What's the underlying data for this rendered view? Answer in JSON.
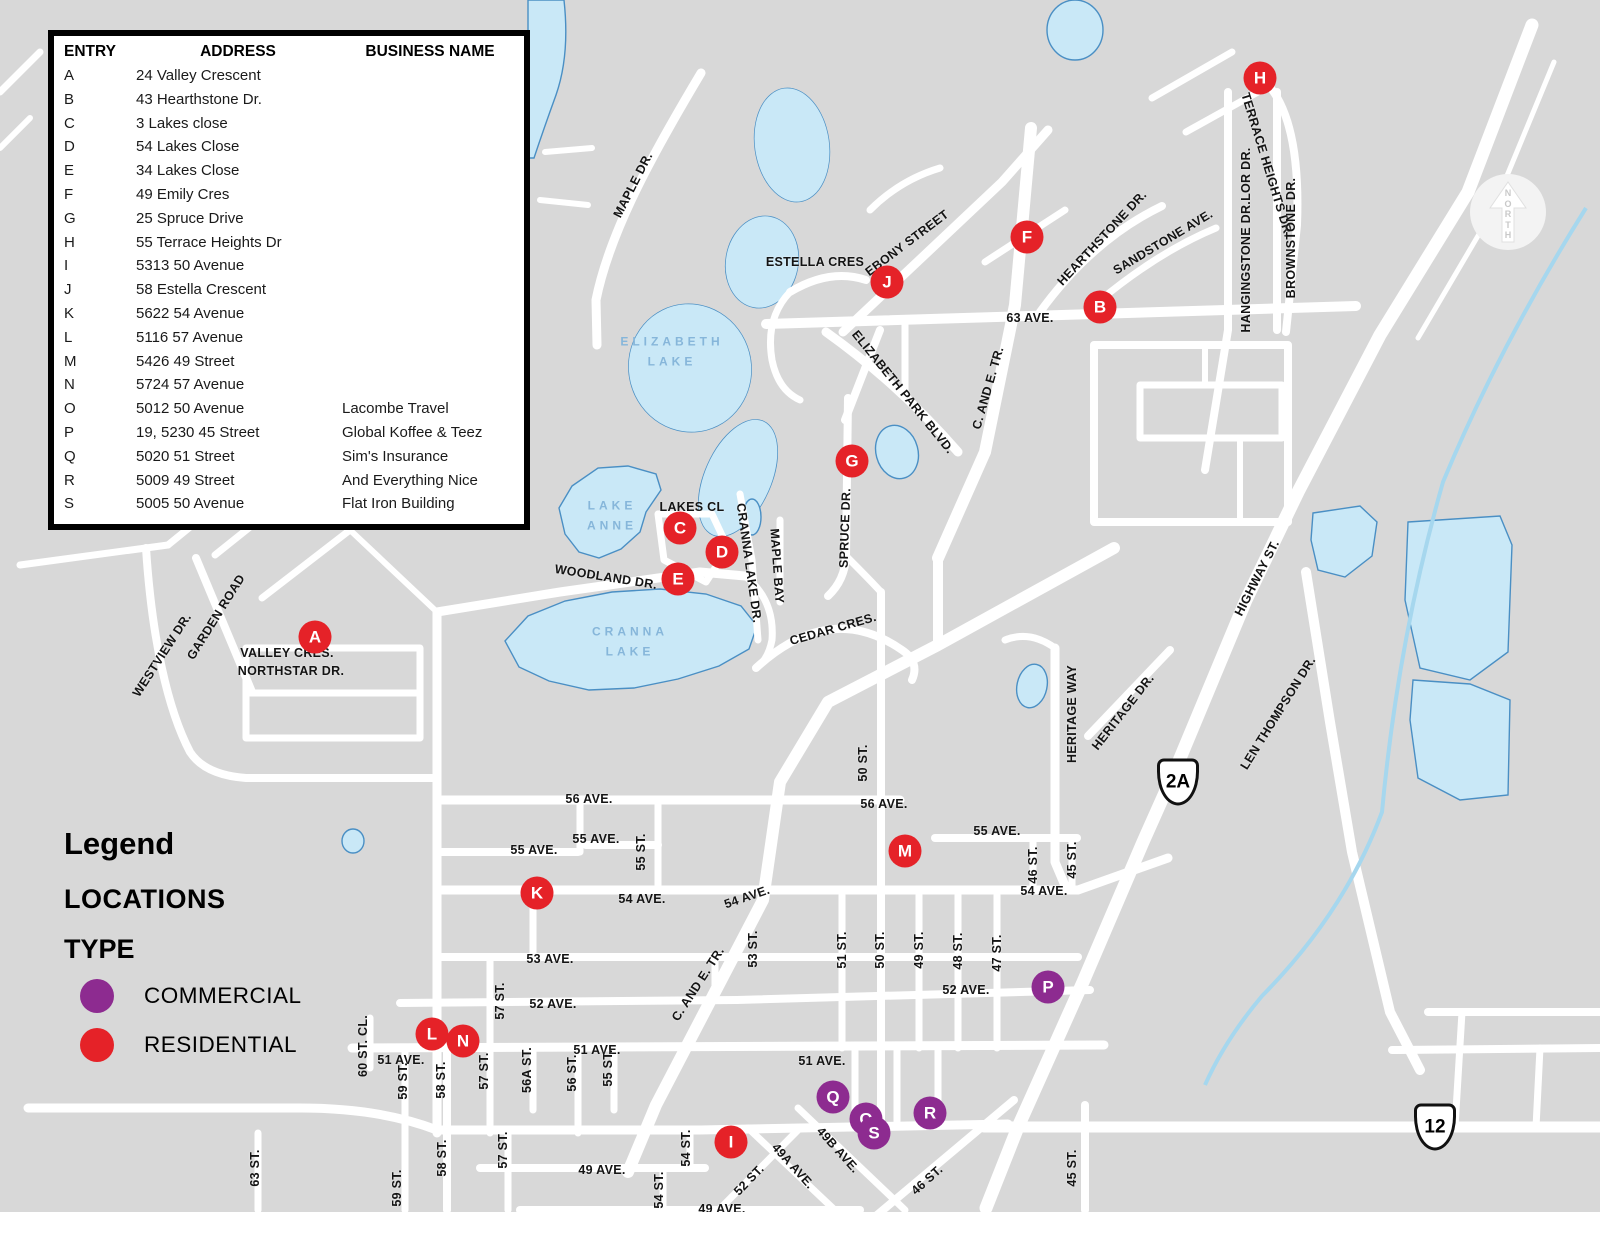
{
  "table": {
    "headers": [
      "ENTRY",
      "ADDRESS",
      "BUSINESS NAME"
    ],
    "rows": [
      {
        "entry": "A",
        "address": "24 Valley Crescent",
        "business": ""
      },
      {
        "entry": "B",
        "address": "43 Hearthstone Dr.",
        "business": ""
      },
      {
        "entry": "C",
        "address": "3 Lakes close",
        "business": ""
      },
      {
        "entry": "D",
        "address": "54 Lakes Close",
        "business": ""
      },
      {
        "entry": "E",
        "address": "34 Lakes Close",
        "business": ""
      },
      {
        "entry": "F",
        "address": "49 Emily Cres",
        "business": ""
      },
      {
        "entry": "G",
        "address": "25 Spruce Drive",
        "business": ""
      },
      {
        "entry": "H",
        "address": "55 Terrace Heights Dr",
        "business": ""
      },
      {
        "entry": "I",
        "address": "5313 50 Avenue",
        "business": ""
      },
      {
        "entry": "J",
        "address": "58 Estella Crescent",
        "business": ""
      },
      {
        "entry": "K",
        "address": "5622 54 Avenue",
        "business": ""
      },
      {
        "entry": "L",
        "address": "5116 57 Avenue",
        "business": ""
      },
      {
        "entry": "M",
        "address": "5426 49 Street",
        "business": ""
      },
      {
        "entry": "N",
        "address": "5724 57 Avenue",
        "business": ""
      },
      {
        "entry": "O",
        "address": "5012 50 Avenue",
        "business": "Lacombe Travel"
      },
      {
        "entry": "P",
        "address": "19, 5230 45 Street",
        "business": "Global Koffee & Teez"
      },
      {
        "entry": "Q",
        "address": "5020 51 Street",
        "business": "Sim's Insurance"
      },
      {
        "entry": "R",
        "address": "5009 49 Street",
        "business": "And Everything Nice"
      },
      {
        "entry": "S",
        "address": "5005 50 Avenue",
        "business": "Flat Iron Building"
      }
    ]
  },
  "legend": {
    "title": "Legend",
    "subtitle": "LOCATIONS",
    "type_label": "TYPE",
    "items": [
      {
        "label": "COMMERCIAL",
        "type": "commercial",
        "color": "#8d2b90"
      },
      {
        "label": "RESIDENTIAL",
        "type": "residential",
        "color": "#e52228"
      }
    ]
  },
  "map": {
    "background": "#d8d8d8",
    "road_color": "#ffffff",
    "water_fill": "#c9e8f7",
    "water_stroke": "#4a8fc4",
    "north": {
      "label": "NORTH"
    },
    "shields": [
      {
        "text": "2A",
        "x": 1178,
        "y": 782
      },
      {
        "text": "12",
        "x": 1435,
        "y": 1127
      }
    ],
    "markers": [
      {
        "id": "A",
        "type": "residential",
        "x": 315,
        "y": 637
      },
      {
        "id": "B",
        "type": "residential",
        "x": 1100,
        "y": 307
      },
      {
        "id": "C",
        "type": "residential",
        "x": 680,
        "y": 528
      },
      {
        "id": "D",
        "type": "residential",
        "x": 722,
        "y": 552
      },
      {
        "id": "E",
        "type": "residential",
        "x": 678,
        "y": 579
      },
      {
        "id": "F",
        "type": "residential",
        "x": 1027,
        "y": 237
      },
      {
        "id": "G",
        "type": "residential",
        "x": 852,
        "y": 461
      },
      {
        "id": "H",
        "type": "residential",
        "x": 1260,
        "y": 78
      },
      {
        "id": "I",
        "type": "residential",
        "x": 731,
        "y": 1142
      },
      {
        "id": "J",
        "type": "residential",
        "x": 887,
        "y": 282
      },
      {
        "id": "K",
        "type": "residential",
        "x": 537,
        "y": 893
      },
      {
        "id": "L",
        "type": "residential",
        "x": 432,
        "y": 1034
      },
      {
        "id": "M",
        "type": "residential",
        "x": 905,
        "y": 851
      },
      {
        "id": "N",
        "type": "residential",
        "x": 463,
        "y": 1041
      },
      {
        "id": "O",
        "type": "commercial",
        "x": 866,
        "y": 1119
      },
      {
        "id": "P",
        "type": "commercial",
        "x": 1048,
        "y": 987
      },
      {
        "id": "Q",
        "type": "commercial",
        "x": 833,
        "y": 1097
      },
      {
        "id": "R",
        "type": "commercial",
        "x": 930,
        "y": 1113
      },
      {
        "id": "S",
        "type": "commercial",
        "x": 874,
        "y": 1133
      }
    ],
    "lake_labels": [
      {
        "lines": [
          "ELIZABETH",
          "LAKE"
        ],
        "x": 672,
        "y": 352
      },
      {
        "lines": [
          "LAKE",
          "ANNE"
        ],
        "x": 612,
        "y": 516
      },
      {
        "lines": [
          "CRANNA",
          "LAKE"
        ],
        "x": 630,
        "y": 642
      }
    ],
    "street_labels": [
      {
        "text": "MAPLE DR.",
        "x": 633,
        "y": 185,
        "rot": -63
      },
      {
        "text": "ESTELLA CRES",
        "x": 815,
        "y": 262,
        "rot": 0
      },
      {
        "text": "EBONY STREET",
        "x": 907,
        "y": 243,
        "rot": -37
      },
      {
        "text": "HEARTHSTONE DR.",
        "x": 1102,
        "y": 238,
        "rot": -47
      },
      {
        "text": "SANDSTONE AVE.",
        "x": 1163,
        "y": 242,
        "rot": -31
      },
      {
        "text": "TERRACE HEIGHTS DR.",
        "x": 1267,
        "y": 165,
        "rot": 73
      },
      {
        "text": "HANGINGSTONE DR.LOR DR.",
        "x": 1246,
        "y": 240,
        "rot": -90
      },
      {
        "text": "BROWNSTONE DR.",
        "x": 1291,
        "y": 238,
        "rot": -90
      },
      {
        "text": "63 AVE.",
        "x": 1030,
        "y": 318,
        "rot": 0
      },
      {
        "text": "C. AND E. TR.",
        "x": 988,
        "y": 388,
        "rot": -74
      },
      {
        "text": "ELIZABETH PARK BLVD.",
        "x": 903,
        "y": 392,
        "rot": 51
      },
      {
        "text": "SPRUCE DR.",
        "x": 845,
        "y": 528,
        "rot": -88
      },
      {
        "text": "LAKES CL",
        "x": 692,
        "y": 507,
        "rot": 0
      },
      {
        "text": "CRANNA LAKE DR.",
        "x": 749,
        "y": 563,
        "rot": 82
      },
      {
        "text": "MAPLE BAY",
        "x": 777,
        "y": 566,
        "rot": 86
      },
      {
        "text": "WOODLAND DR.",
        "x": 606,
        "y": 577,
        "rot": 9
      },
      {
        "text": "CEDAR CRES.",
        "x": 833,
        "y": 629,
        "rot": -16
      },
      {
        "text": "VALLEY CRES.",
        "x": 287,
        "y": 653,
        "rot": 0
      },
      {
        "text": "NORTHSTAR DR.",
        "x": 291,
        "y": 671,
        "rot": 0
      },
      {
        "text": "WESTVIEW DR.",
        "x": 162,
        "y": 655,
        "rot": -57
      },
      {
        "text": "GARDEN ROAD",
        "x": 216,
        "y": 617,
        "rot": -58
      },
      {
        "text": "HERITAGE WAY",
        "x": 1072,
        "y": 714,
        "rot": -90
      },
      {
        "text": "HERITAGE DR.",
        "x": 1123,
        "y": 712,
        "rot": -52
      },
      {
        "text": "HIGHWAY ST.",
        "x": 1257,
        "y": 578,
        "rot": -63
      },
      {
        "text": "LEN THOMPSON DR.",
        "x": 1278,
        "y": 713,
        "rot": -58
      },
      {
        "text": "50 ST.",
        "x": 863,
        "y": 763,
        "rot": -90
      },
      {
        "text": "56 AVE.",
        "x": 589,
        "y": 799,
        "rot": 0
      },
      {
        "text": "56 AVE.",
        "x": 884,
        "y": 804,
        "rot": 0
      },
      {
        "text": "55 AVE.",
        "x": 534,
        "y": 850,
        "rot": 0
      },
      {
        "text": "55 AVE.",
        "x": 596,
        "y": 839,
        "rot": 0
      },
      {
        "text": "55 AVE.",
        "x": 997,
        "y": 831,
        "rot": 0
      },
      {
        "text": "55 ST.",
        "x": 641,
        "y": 852,
        "rot": -90
      },
      {
        "text": "54 AVE.",
        "x": 642,
        "y": 899,
        "rot": 0
      },
      {
        "text": "54 AVE.",
        "x": 747,
        "y": 897,
        "rot": -19
      },
      {
        "text": "54 AVE.",
        "x": 1044,
        "y": 891,
        "rot": 0
      },
      {
        "text": "53 AVE.",
        "x": 550,
        "y": 959,
        "rot": 0
      },
      {
        "text": "53 ST.",
        "x": 753,
        "y": 949,
        "rot": -90
      },
      {
        "text": "51 ST.",
        "x": 842,
        "y": 950,
        "rot": -90
      },
      {
        "text": "50 ST.",
        "x": 880,
        "y": 950,
        "rot": -90
      },
      {
        "text": "49 ST.",
        "x": 919,
        "y": 950,
        "rot": -90
      },
      {
        "text": "48 ST.",
        "x": 958,
        "y": 951,
        "rot": -90
      },
      {
        "text": "47 ST.",
        "x": 997,
        "y": 953,
        "rot": -90
      },
      {
        "text": "46 ST.",
        "x": 1033,
        "y": 865,
        "rot": -90
      },
      {
        "text": "45 ST.",
        "x": 1072,
        "y": 860,
        "rot": -90
      },
      {
        "text": "52 AVE.",
        "x": 553,
        "y": 1004,
        "rot": 0
      },
      {
        "text": "52 AVE.",
        "x": 966,
        "y": 990,
        "rot": 0
      },
      {
        "text": "57 ST.",
        "x": 500,
        "y": 1001,
        "rot": -90
      },
      {
        "text": "C. AND E. TR.",
        "x": 698,
        "y": 984,
        "rot": -57
      },
      {
        "text": "51 AVE.",
        "x": 401,
        "y": 1060,
        "rot": 0
      },
      {
        "text": "51 AVE.",
        "x": 597,
        "y": 1050,
        "rot": 0
      },
      {
        "text": "51 AVE.",
        "x": 822,
        "y": 1061,
        "rot": 0
      },
      {
        "text": "60 ST. CL.",
        "x": 363,
        "y": 1046,
        "rot": -90
      },
      {
        "text": "59 ST.",
        "x": 403,
        "y": 1081,
        "rot": -90
      },
      {
        "text": "58 ST.",
        "x": 441,
        "y": 1080,
        "rot": -90
      },
      {
        "text": "57 ST.",
        "x": 484,
        "y": 1071,
        "rot": -90
      },
      {
        "text": "56A ST.",
        "x": 527,
        "y": 1070,
        "rot": -90
      },
      {
        "text": "56 ST.",
        "x": 572,
        "y": 1073,
        "rot": -90
      },
      {
        "text": "55 ST.",
        "x": 608,
        "y": 1068,
        "rot": -90
      },
      {
        "text": "63 ST.",
        "x": 255,
        "y": 1168,
        "rot": -90
      },
      {
        "text": "59 ST.",
        "x": 397,
        "y": 1188,
        "rot": -90
      },
      {
        "text": "58 ST.",
        "x": 442,
        "y": 1158,
        "rot": -90
      },
      {
        "text": "57 ST.",
        "x": 503,
        "y": 1150,
        "rot": -90
      },
      {
        "text": "49 AVE.",
        "x": 602,
        "y": 1170,
        "rot": 0
      },
      {
        "text": "49 AVE.",
        "x": 722,
        "y": 1209,
        "rot": 0
      },
      {
        "text": "54 ST.",
        "x": 686,
        "y": 1148,
        "rot": -90
      },
      {
        "text": "54 ST.",
        "x": 659,
        "y": 1190,
        "rot": -90
      },
      {
        "text": "52 ST.",
        "x": 749,
        "y": 1180,
        "rot": -46
      },
      {
        "text": "49A AVE.",
        "x": 793,
        "y": 1166,
        "rot": 48
      },
      {
        "text": "49B AVE.",
        "x": 838,
        "y": 1150,
        "rot": 48
      },
      {
        "text": "46 ST.",
        "x": 927,
        "y": 1180,
        "rot": -42
      },
      {
        "text": "45 ST.",
        "x": 1072,
        "y": 1168,
        "rot": -90
      }
    ]
  }
}
